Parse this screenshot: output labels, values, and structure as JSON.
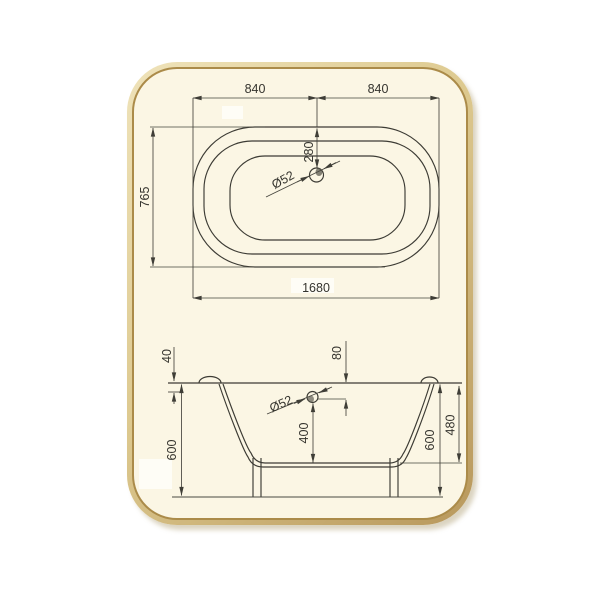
{
  "drawing_title": "bathtub-dimension-drawing",
  "top_view": {
    "dim_width_left": "840",
    "dim_width_right": "840",
    "dim_depth": "765",
    "dim_total_width": "1680",
    "dim_drain_offset": "280",
    "dim_drain_diameter": "Ø52"
  },
  "section_view": {
    "dim_rim_lip": "40",
    "dim_drain_from_rim": "80",
    "dim_drain_diameter": "Ø52",
    "dim_drain_to_floor": "400",
    "dim_height_left": "600",
    "dim_height_right": "600",
    "dim_tub_depth": "480"
  },
  "colors": {
    "page_background": "#ffffff",
    "card_background": "#fbf6e4",
    "card_border": "#ab8b49",
    "card_bevel_light": "#efe3ba",
    "card_bevel_dark": "#b8985c",
    "line_color": "#45443d"
  }
}
